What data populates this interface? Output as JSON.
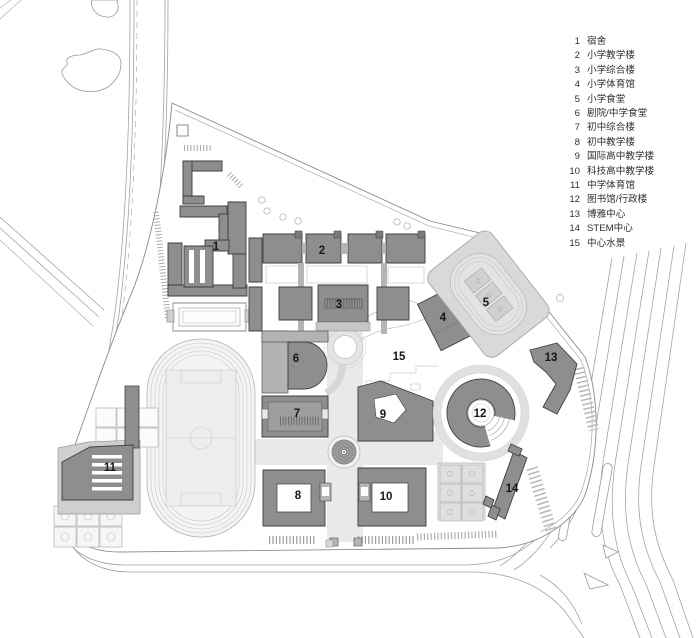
{
  "buildings": [
    {
      "num": "1",
      "label": "宿舍"
    },
    {
      "num": "2",
      "label": "小学教学楼"
    },
    {
      "num": "3",
      "label": "小学综合楼"
    },
    {
      "num": "4",
      "label": "小学体育馆"
    },
    {
      "num": "5",
      "label": "小学食堂"
    },
    {
      "num": "6",
      "label": "剧院/中学食堂"
    },
    {
      "num": "7",
      "label": "初中综合楼"
    },
    {
      "num": "8",
      "label": "初中教学楼"
    },
    {
      "num": "9",
      "label": "国际高中教学楼"
    },
    {
      "num": "10",
      "label": "科技高中教学楼"
    },
    {
      "num": "11",
      "label": "中学体育馆"
    },
    {
      "num": "12",
      "label": "图书馆/行政楼"
    },
    {
      "num": "13",
      "label": "博雅中心"
    },
    {
      "num": "14",
      "label": "STEM中心"
    },
    {
      "num": "15",
      "label": "中心水景"
    }
  ],
  "colors": {
    "building_fill": "#8e8e8e",
    "building_outline": "#3f3f3f",
    "podium": "#b9b9b9",
    "paving": "#e9e9e9",
    "sports_plot": "#d9d9d9",
    "line": "#9a9a9a",
    "label_text": "#161616"
  }
}
